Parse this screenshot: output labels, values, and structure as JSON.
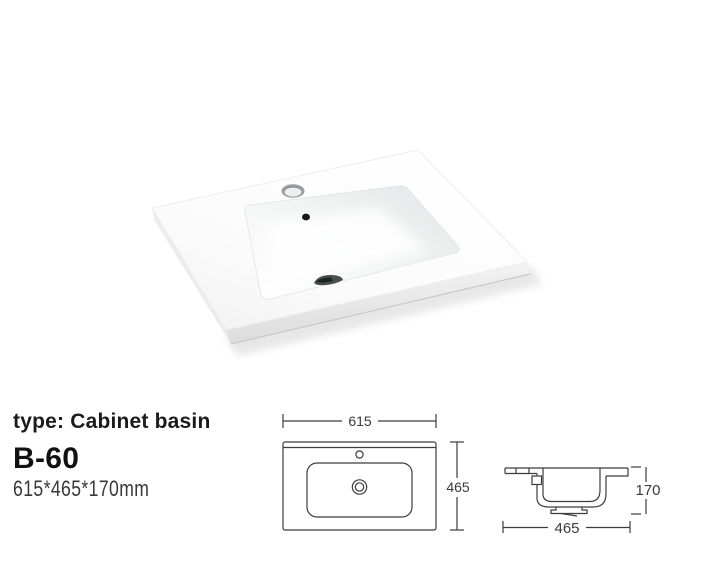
{
  "canvas": {
    "width": 714,
    "height": 573,
    "background": "#ffffff"
  },
  "colors": {
    "drawing_line": "#3c3c3c",
    "text_primary": "#1b1b1b",
    "ceramic_white": "#fdfdfd",
    "ceramic_shadow": "#e0e0e0"
  },
  "info": {
    "type_label": "type: Cabinet basin",
    "model": "B-60",
    "dimensions": "615*465*170mm"
  },
  "photo": {
    "label": "cabinet-basin-photo"
  },
  "drawings": {
    "plan": {
      "width_mm": "615",
      "depth_mm": "465"
    },
    "section": {
      "depth_mm": "465",
      "height_mm": "170"
    }
  }
}
